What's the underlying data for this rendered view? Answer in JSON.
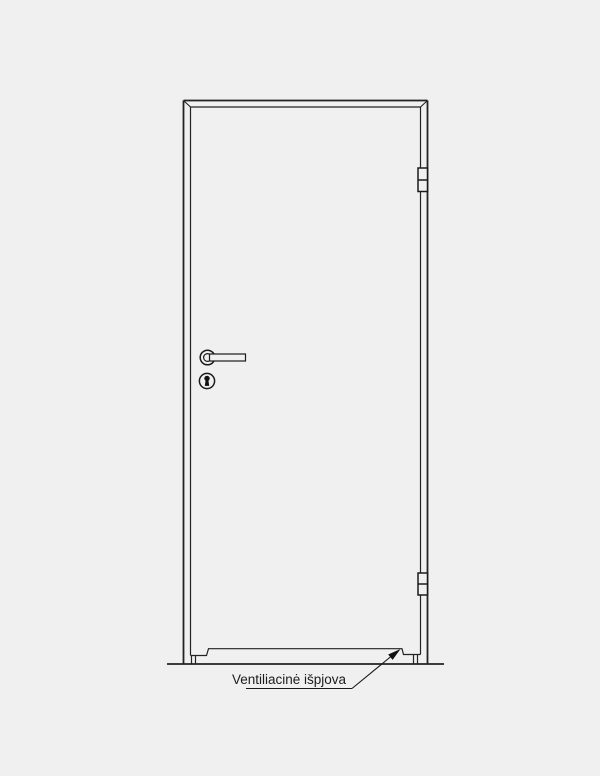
{
  "colors": {
    "background": "#f0f0f0",
    "line": "#222222",
    "fill_inside": "#f0f0f0",
    "keyhole_fill": "#111111"
  },
  "diagram": {
    "type": "door-elevation-technical-drawing",
    "label": "Ventiliacinė išpjova",
    "parts": [
      "door-frame",
      "door-leaf",
      "door-handle",
      "keyhole",
      "hinge-top",
      "hinge-bottom",
      "ventilation-cutout",
      "floor-line",
      "leader-arrow"
    ]
  }
}
